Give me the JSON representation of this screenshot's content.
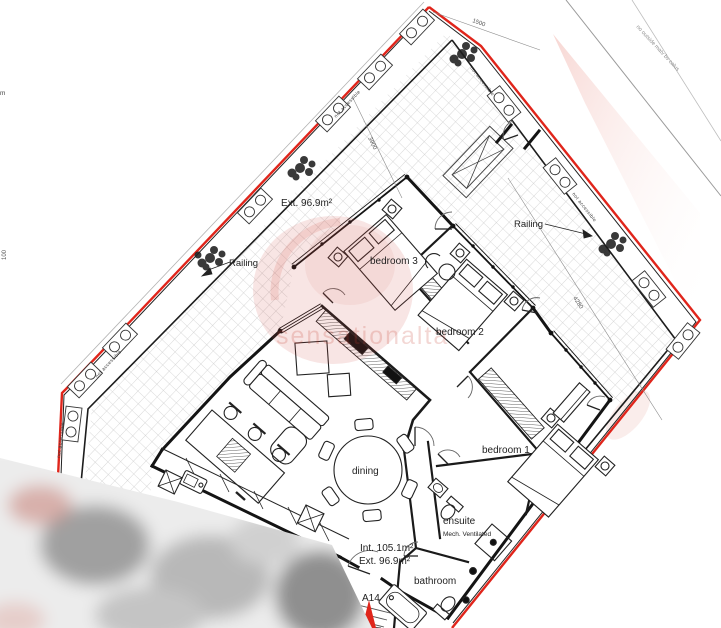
{
  "colors": {
    "background": "#ffffff",
    "line": "#1f1f1f",
    "boundary_red": "#e0251b",
    "hatch_gray": "#cbcbcb",
    "watermark_red": "#c0392b"
  },
  "unit": {
    "ref": "A14",
    "internal_area": "Int. 105.1m²",
    "external_area": "Ext. 96.9m²",
    "terrace_area": "Ext. 96.9m²"
  },
  "rooms": {
    "bedroom1": "bedroom 1",
    "bedroom2": "bedroom 2",
    "bedroom3": "bedroom 3",
    "dining": "dining",
    "ensuite": "ensuite",
    "ensuite_note": "Mech. Ventilated",
    "bathroom": "bathroom"
  },
  "annotations": {
    "railing": "Railing",
    "not_accessible": "not accessible",
    "adjacent_text": "no outside matv bv calus",
    "edge_label_top": "m",
    "edge_label_left": "100"
  },
  "dimensions": {
    "d1500": "1500",
    "d3900": "3900",
    "d4280": "4280"
  },
  "watermark": {
    "text": "sensationalta"
  }
}
